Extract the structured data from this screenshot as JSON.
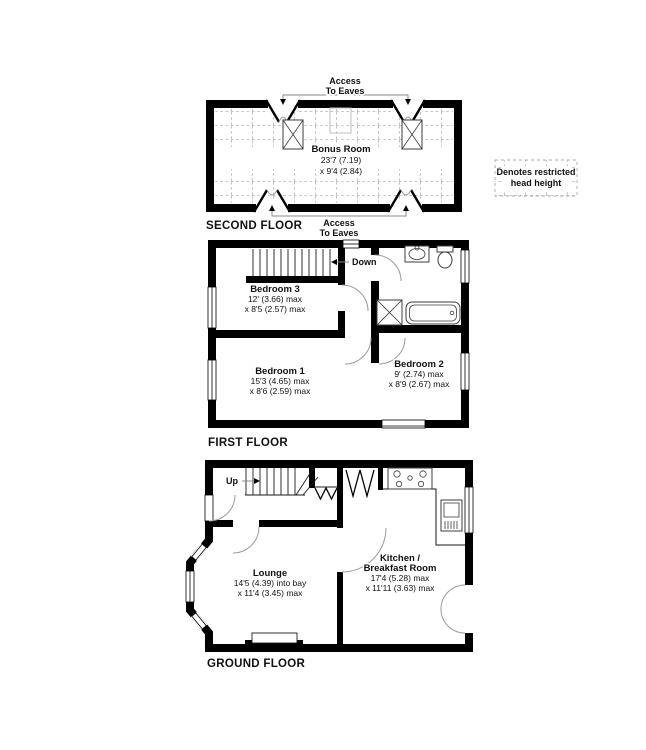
{
  "legend": {
    "line1": "Denotes restricted",
    "line2": "head height"
  },
  "second_floor": {
    "label": "SECOND FLOOR",
    "room": {
      "name": "Bonus Room",
      "dim1": "23'7 (7.19)",
      "dim2": "x 9'4 (2.84)"
    },
    "access_top": {
      "line1": "Access",
      "line2": "To Eaves"
    },
    "access_bottom": {
      "line1": "Access",
      "line2": "To Eaves"
    }
  },
  "first_floor": {
    "label": "FIRST FLOOR",
    "stairs_label": "Down",
    "bedroom3": {
      "name": "Bedroom 3",
      "dim1": "12' (3.66) max",
      "dim2": "x 8'5 (2.57) max"
    },
    "bedroom1": {
      "name": "Bedroom 1",
      "dim1": "15'3 (4.65) max",
      "dim2": "x 8'6 (2.59) max"
    },
    "bedroom2": {
      "name": "Bedroom 2",
      "dim1": "9' (2.74) max",
      "dim2": "x 8'9 (2.67) max"
    }
  },
  "ground_floor": {
    "label": "GROUND FLOOR",
    "stairs_label": "Up",
    "lounge": {
      "name": "Lounge",
      "dim1": "14'5 (4.39) into bay",
      "dim2": "x 11'4 (3.45) max"
    },
    "kitchen": {
      "name": "Kitchen /",
      "name2": "Breakfast Room",
      "dim1": "17'4 (5.28) max",
      "dim2": "x 11'11 (3.63) max"
    }
  },
  "colors": {
    "wall": "#000000",
    "door_arc": "#9a9a9a",
    "restricted_dash": "#b3b3b3",
    "background": "#ffffff"
  }
}
